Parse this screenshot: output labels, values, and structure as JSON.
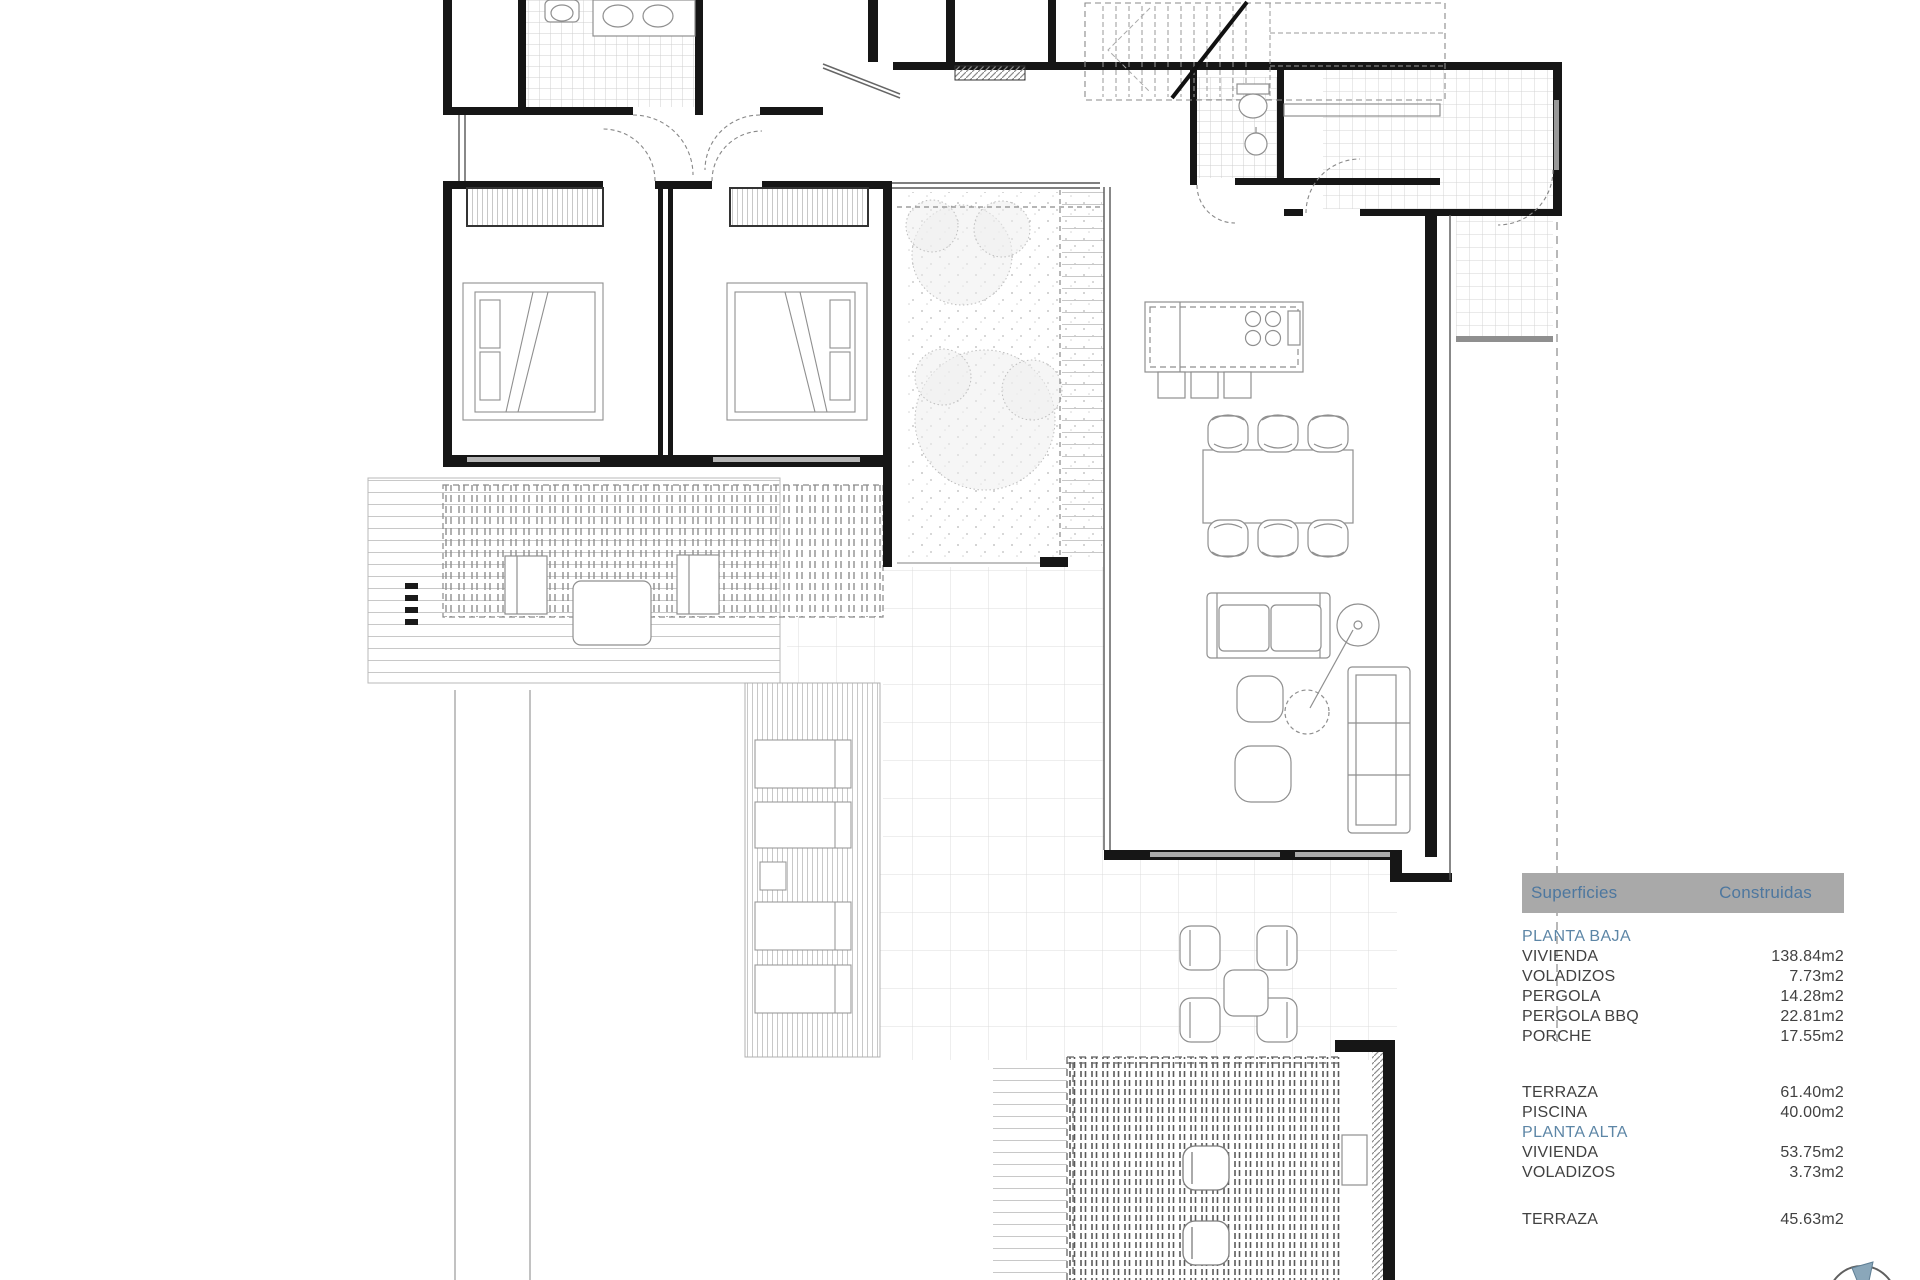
{
  "legend": {
    "header_left": "Superficies",
    "header_right": "Construidas",
    "items": [
      {
        "t": "section",
        "label": "PLANTA BAJA"
      },
      {
        "t": "row",
        "label": "VIVIENDA",
        "value": "138.84m2"
      },
      {
        "t": "row",
        "label": "VOLADIZOS",
        "value": "7.73m2"
      },
      {
        "t": "row",
        "label": "PERGOLA",
        "value": "14.28m2"
      },
      {
        "t": "row",
        "label": "PERGOLA BBQ",
        "value": "22.81m2"
      },
      {
        "t": "row",
        "label": "PORCHE",
        "value": "17.55m2"
      },
      {
        "t": "row",
        "label": "TERRAZA",
        "value": "61.40m2"
      },
      {
        "t": "row",
        "label": "PISCINA",
        "value": "40.00m2"
      },
      {
        "t": "section",
        "label": "PLANTA ALTA"
      },
      {
        "t": "row",
        "label": "VIVIENDA",
        "value": "53.75m2"
      },
      {
        "t": "row",
        "label": "VOLADIZOS",
        "value": "3.73m2"
      },
      {
        "t": "row",
        "label": "TERRAZA",
        "value": "45.63m2"
      }
    ]
  },
  "colors": {
    "legend_bar": "#a9a9a9",
    "legend_header_text": "#4d779f",
    "legend_section_text": "#5d86a6",
    "legend_row_text": "#414141",
    "wall": "#161616",
    "compass_needle": "#8aa7ba"
  }
}
